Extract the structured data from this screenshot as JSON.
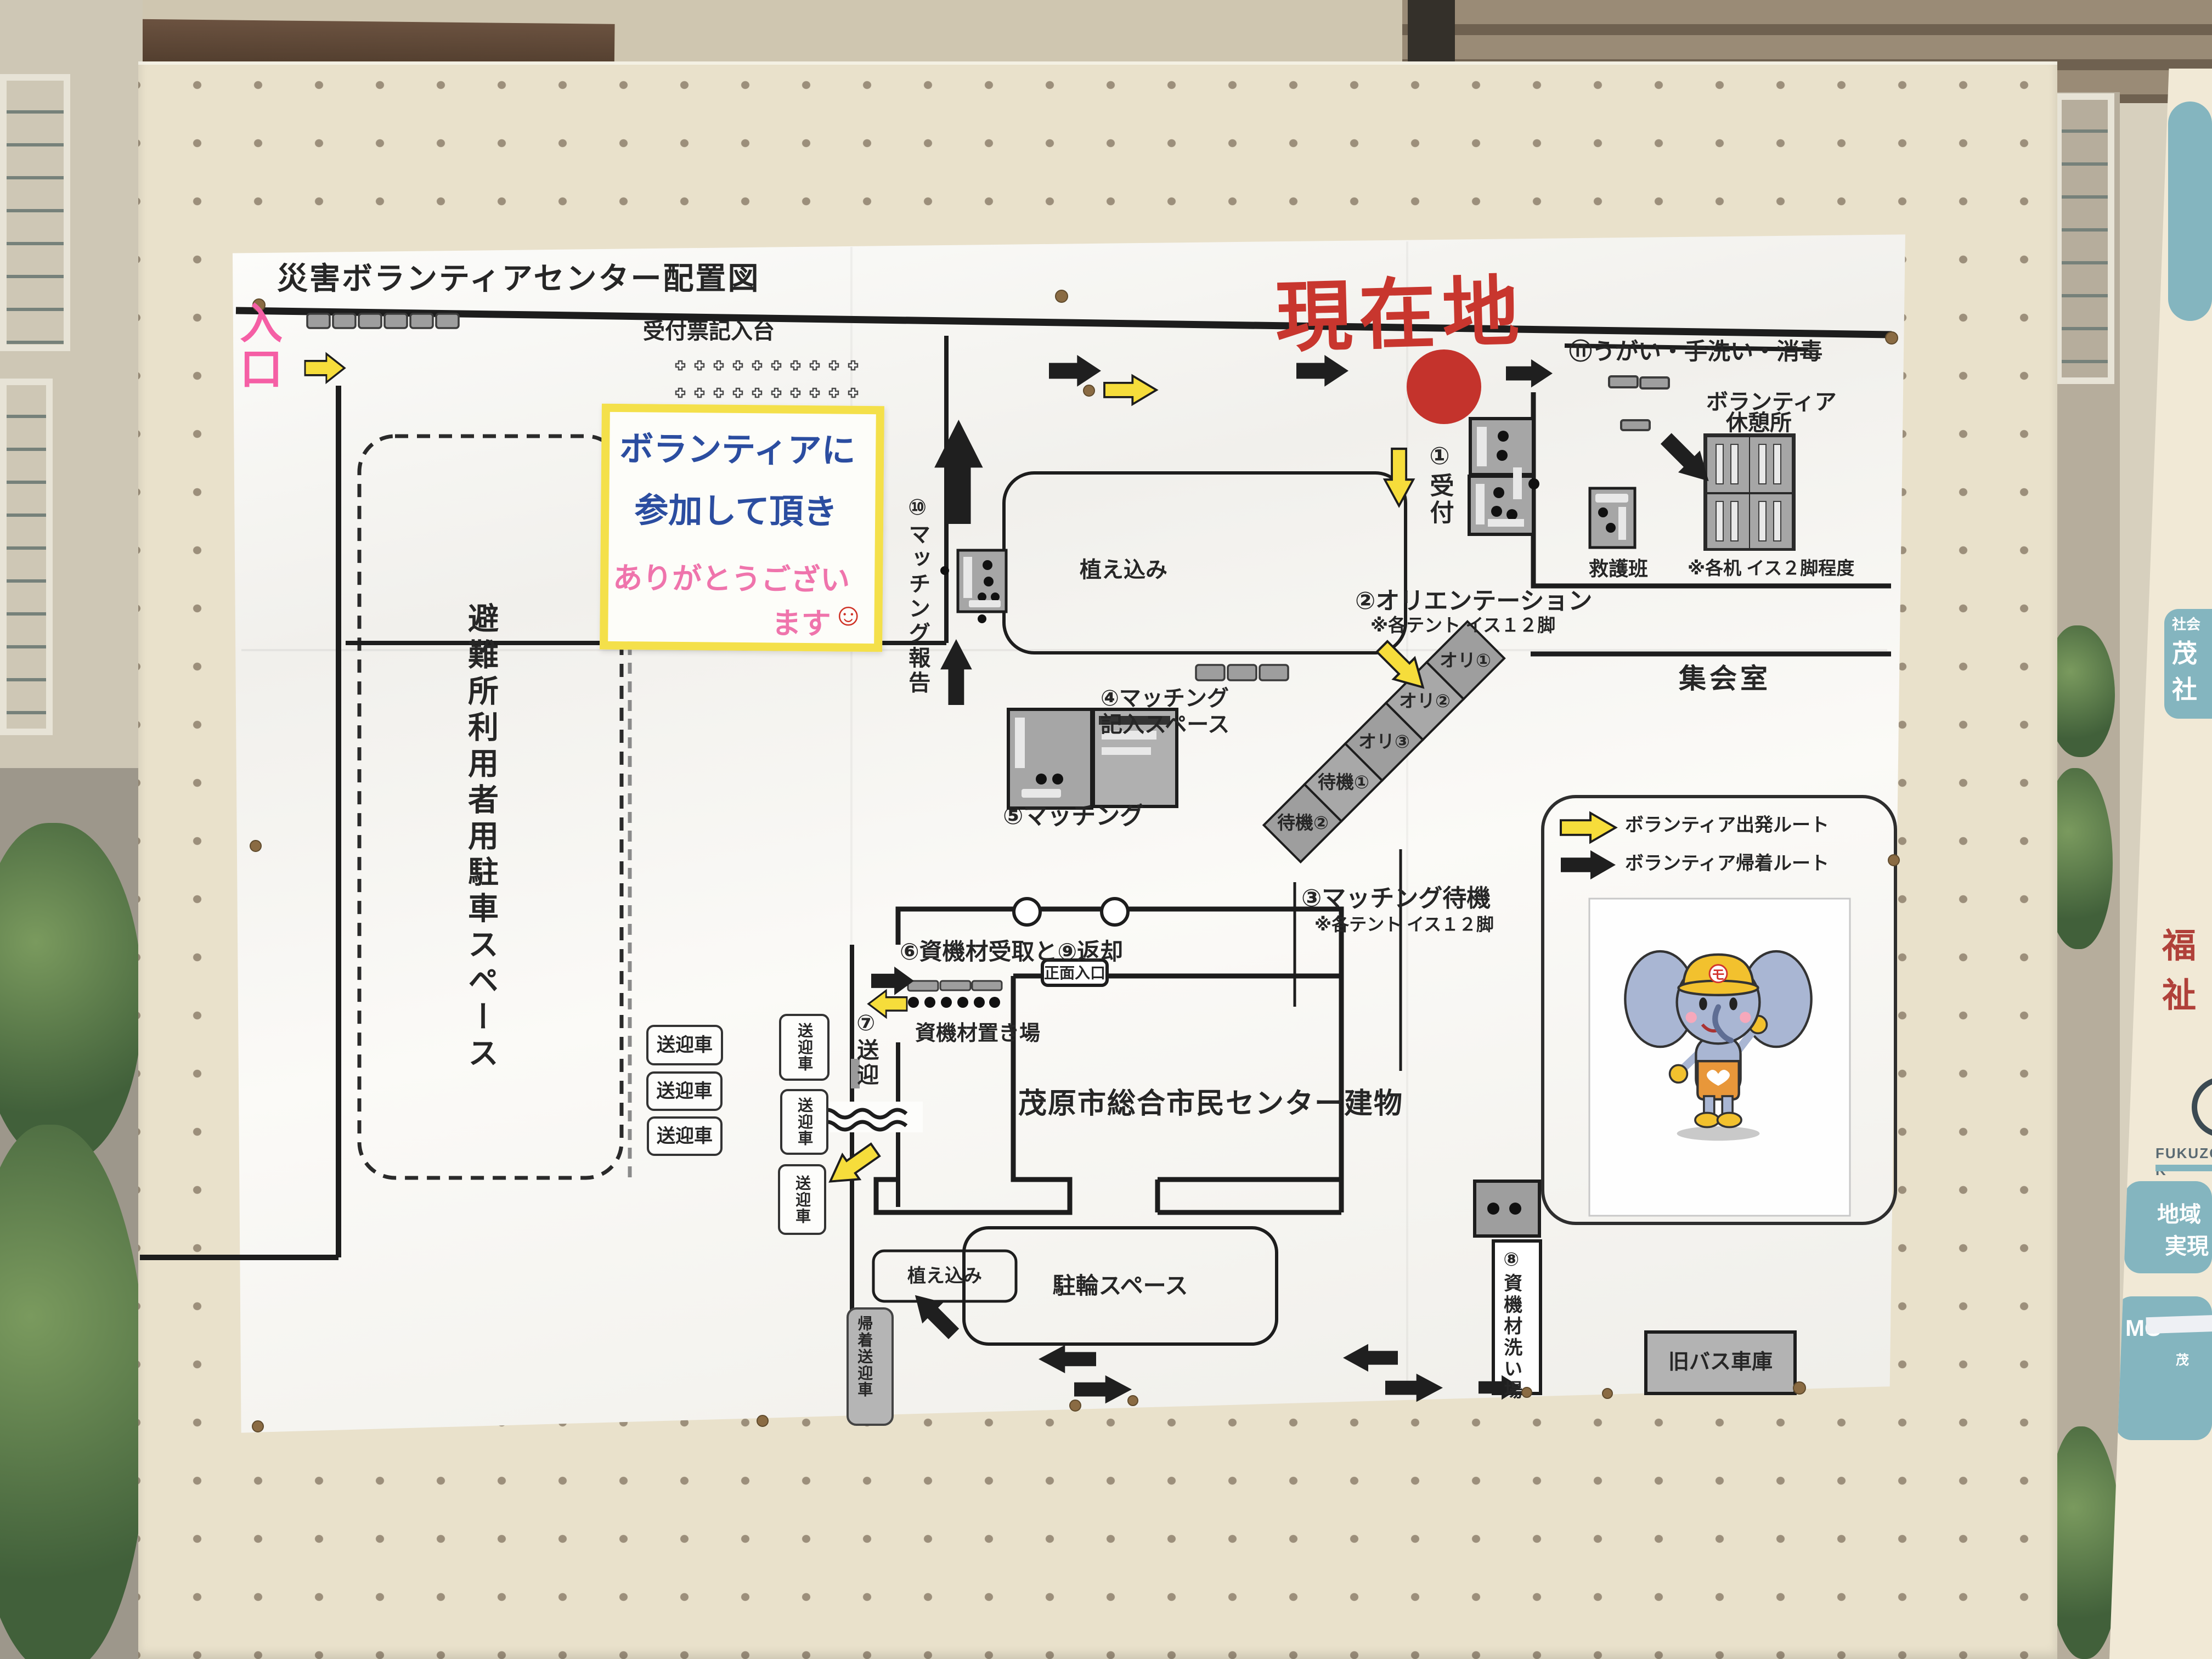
{
  "map": {
    "title": "災害ボランティアセンター配置図",
    "entrance": "入口",
    "reception_writing_desk": "受付票記入台",
    "current_location": "現在地",
    "note": {
      "l1": "ボランティアに",
      "l2": "参加して頂き",
      "l3": "ありがとうござい",
      "l4": "ます",
      "smiley": "☺"
    },
    "s1": "①受付",
    "s2": "②オリエンテーション",
    "s2n": "※各テント イス１２脚",
    "s3": "③マッチング待機",
    "s3n": "※各テント イス１２脚",
    "s4a": "④マッチング",
    "s4b": "記入スペース",
    "s5": "⑤マッチング",
    "s6": "⑥資機材受取と⑨返却",
    "s7": "⑦送迎",
    "s8": "⑧資機材洗い場",
    "s10": "⑩マッチング報告",
    "s11": "⑪うがい・手洗い・消毒",
    "rest1": "ボランティア",
    "rest2": "休憩所",
    "rest_note": "※各机 イス２脚程度",
    "first_aid": "救護班",
    "meeting_room": "集会室",
    "tents": [
      "オリ①",
      "オリ②",
      "オリ③",
      "待機①",
      "待機②"
    ],
    "legend_depart": "ボランティア出発ルート",
    "legend_return": "ボランティア帰着ルート",
    "planting_top": "植え込み",
    "planting_bottom": "植え込み",
    "equip_storage": "資機材置き場",
    "main_entrance": "正面入口",
    "building": "茂原市総合市民センター建物",
    "parking": "避難所利用者用駐車スペース",
    "shuttles": [
      "送迎車",
      "送迎車",
      "送迎車",
      "送迎車",
      "送迎車",
      "送迎車"
    ],
    "return_shuttle": "帰着送迎車",
    "bike_space": "駐輪スペース",
    "old_bus_garage": "旧バス車庫",
    "mascot_badge": "モ"
  },
  "side_sign": {
    "org_small": "社会",
    "org_big1": "茂",
    "org_big2": "社",
    "welfare": "福祉",
    "romaji": "FUKUZO-K",
    "region1": "地域",
    "region2": "実現",
    "mo": "MO",
    "mo_small": "茂"
  },
  "colors": {
    "route_depart_yellow": "#f6dd3b",
    "route_return_black": "#1f1f1f",
    "current_location_red": "#c8362e",
    "note_border_yellow": "#f4e04a",
    "sign_teal": "#84b5bf"
  }
}
